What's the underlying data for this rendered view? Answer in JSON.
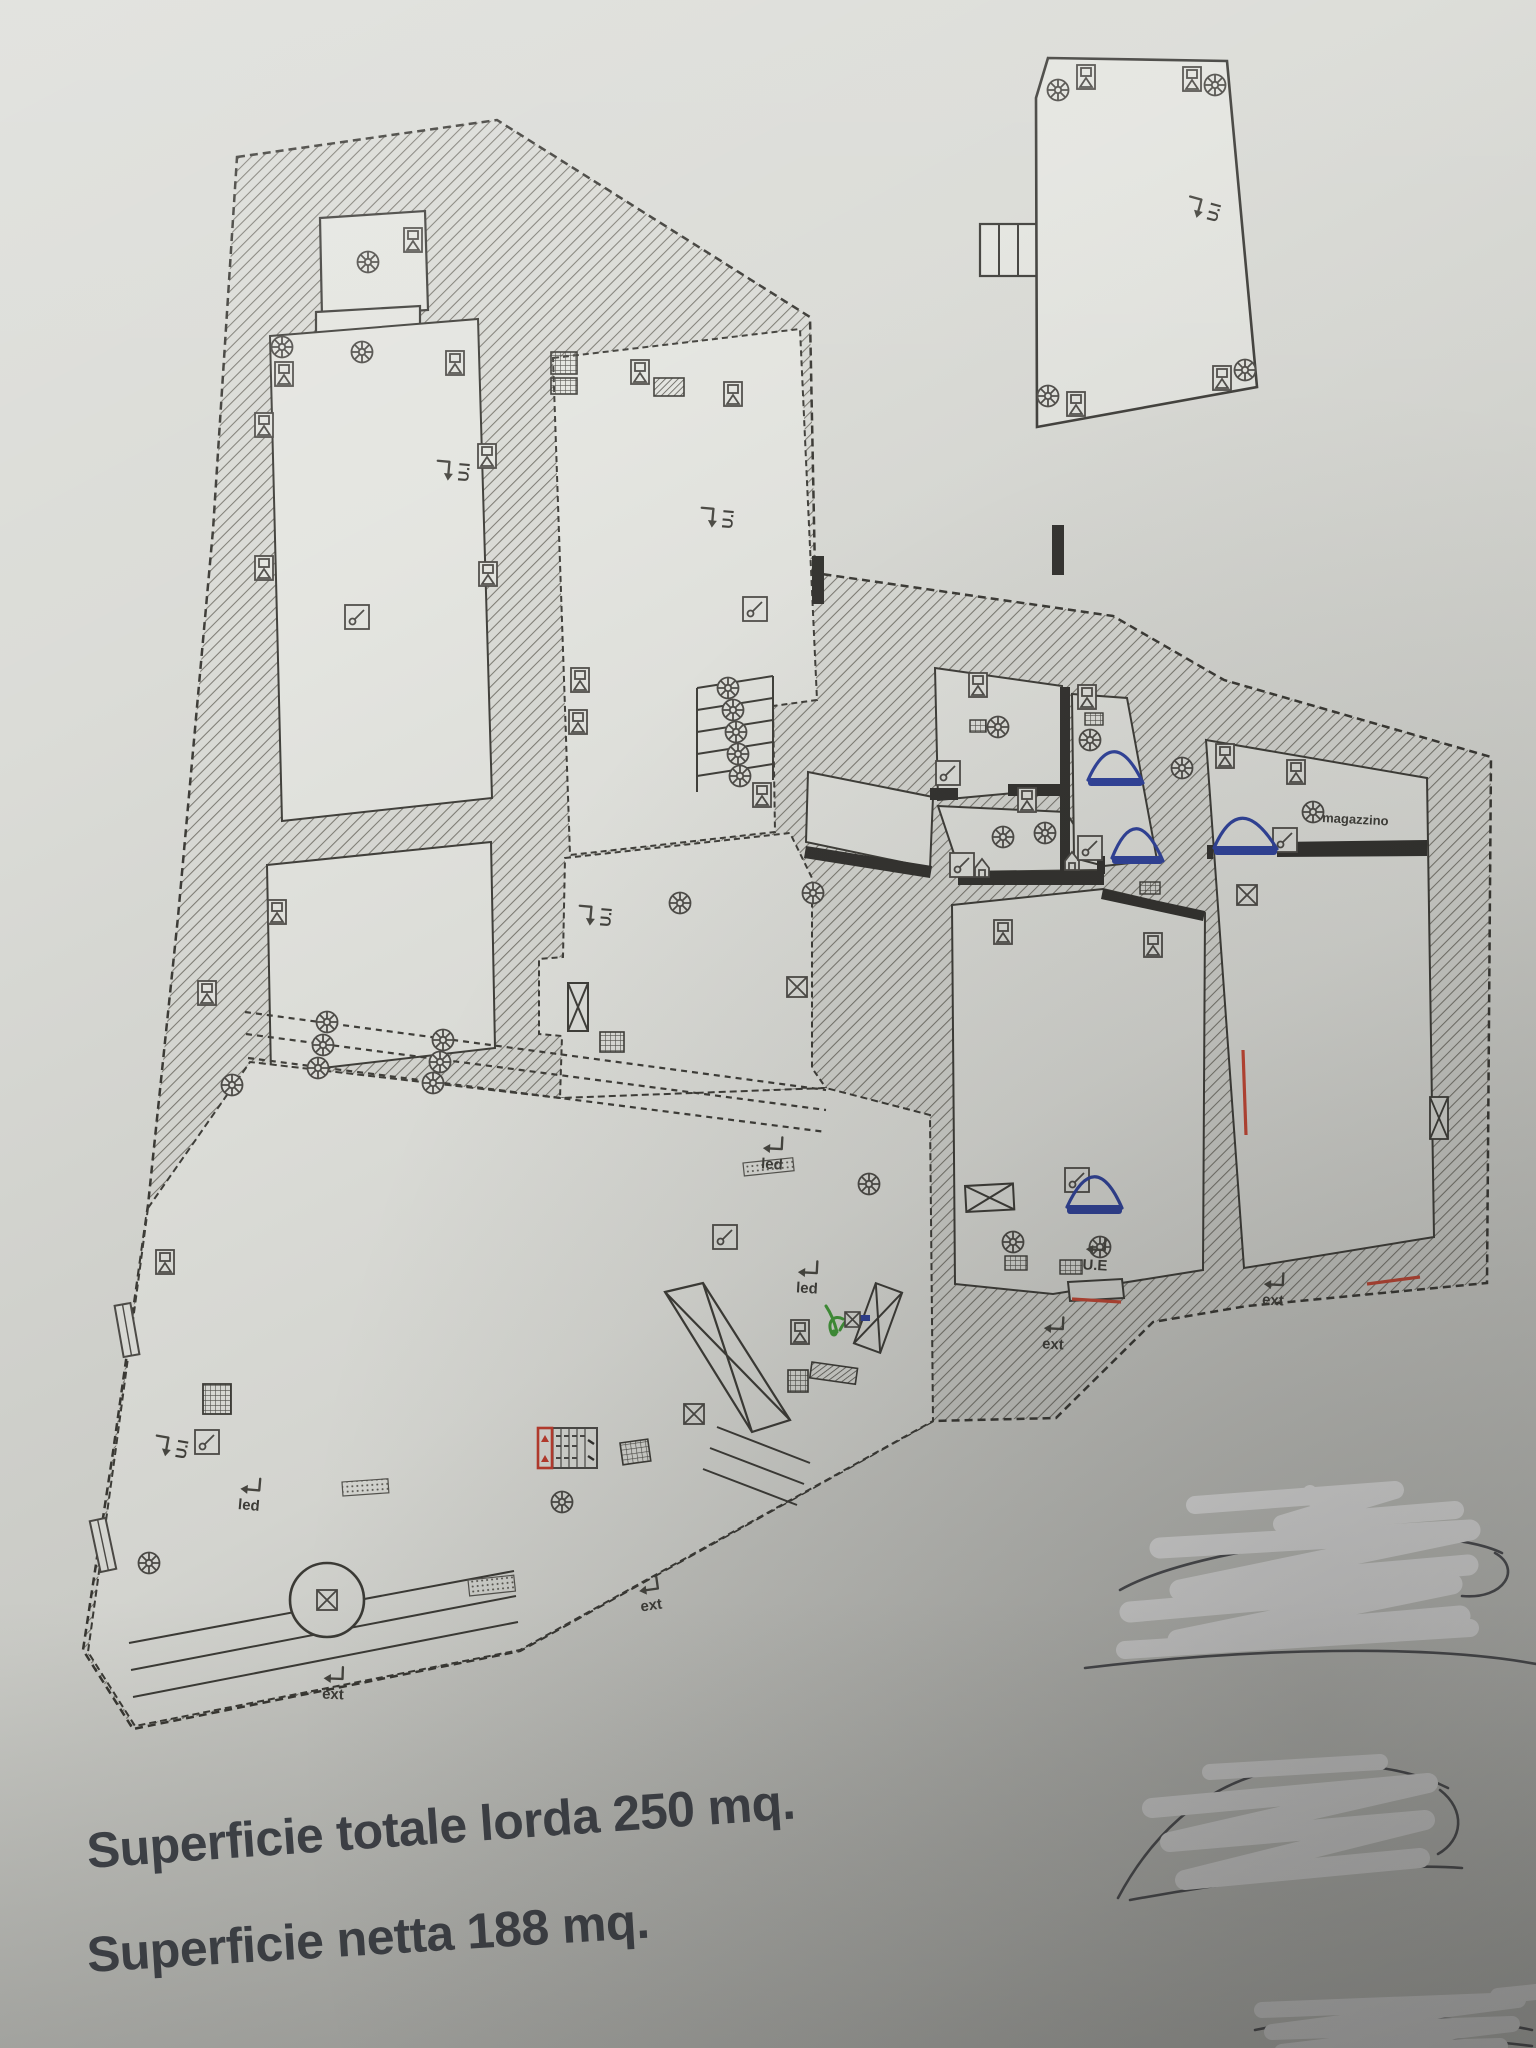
{
  "summary": {
    "line1": "Superficie totale lorda 250 mq.",
    "line2": "Superficie netta 188 mq."
  },
  "plan_labels": {
    "unit_entrance": "U.I",
    "external_exit": "U.E",
    "external": "ext",
    "led": "led",
    "storage_room": "magazzino"
  },
  "colors": {
    "paper": "#d9dad5",
    "room_fill": "#e3e4df",
    "ink": "#3a3936",
    "door_blue": "#2b3f9e",
    "accent_red": "#c5392a",
    "accent_green": "#3f9c35",
    "scribble_white": "#ffffff",
    "summary_text": "#3f434b"
  }
}
